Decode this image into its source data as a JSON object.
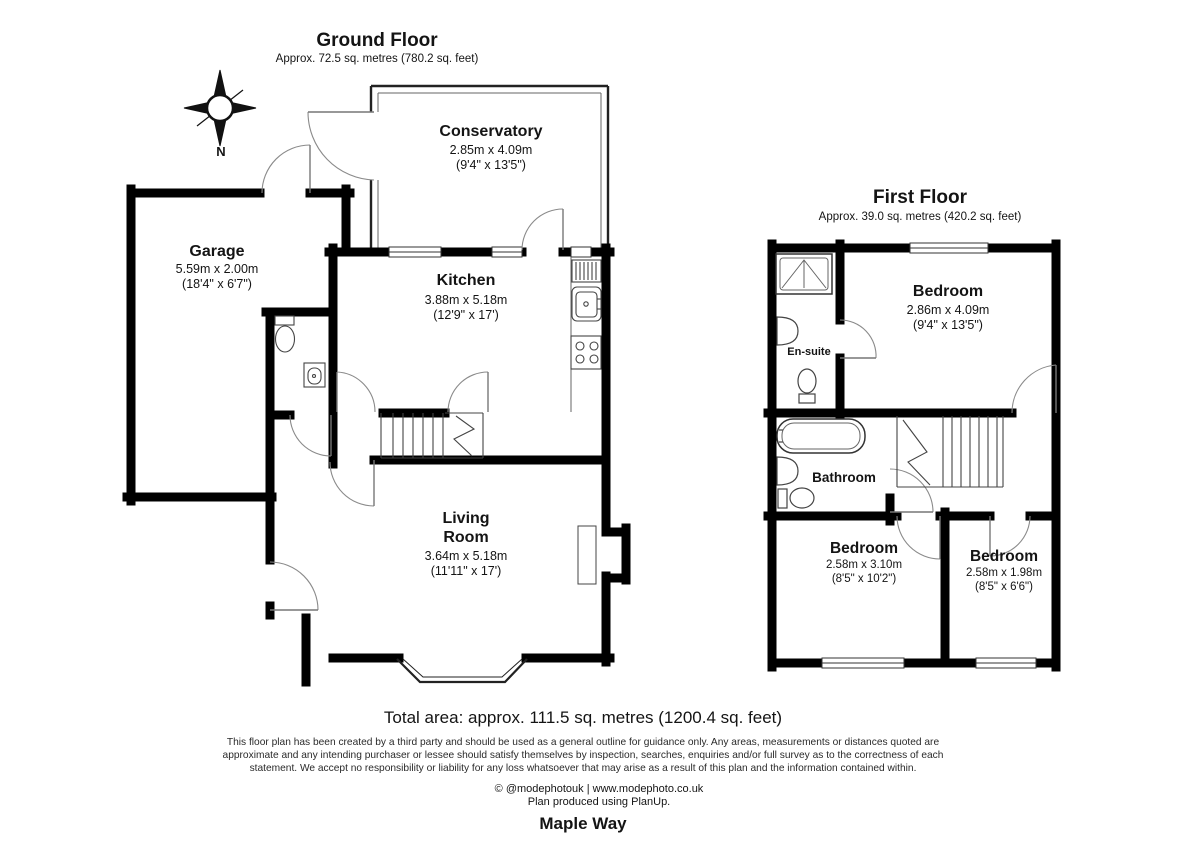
{
  "page": {
    "background": "#ffffff",
    "wall_color": "#000000"
  },
  "compass": {
    "label": "N"
  },
  "ground_floor": {
    "title": "Ground Floor",
    "area": "Approx. 72.5 sq. metres (780.2 sq. feet)",
    "rooms": {
      "conservatory": {
        "name": "Conservatory",
        "metric": "2.85m x 4.09m",
        "imperial": "(9'4\" x 13'5\")"
      },
      "garage": {
        "name": "Garage",
        "metric": "5.59m x 2.00m",
        "imperial": "(18'4\" x 6'7\")"
      },
      "kitchen": {
        "name": "Kitchen",
        "metric": "3.88m x 5.18m",
        "imperial": "(12'9\" x 17')"
      },
      "living_room": {
        "name_line1": "Living",
        "name_line2": "Room",
        "metric": "3.64m x 5.18m",
        "imperial": "(11'11\" x 17')"
      }
    }
  },
  "first_floor": {
    "title": "First Floor",
    "area": "Approx. 39.0 sq. metres (420.2 sq. feet)",
    "rooms": {
      "bedroom_main": {
        "name": "Bedroom",
        "metric": "2.86m x 4.09m",
        "imperial": "(9'4\" x 13'5\")"
      },
      "ensuite": {
        "name": "En-suite"
      },
      "bathroom": {
        "name": "Bathroom"
      },
      "bedroom_left": {
        "name": "Bedroom",
        "metric": "2.58m x 3.10m",
        "imperial": "(8'5\" x 10'2\")"
      },
      "bedroom_right": {
        "name": "Bedroom",
        "metric": "2.58m x 1.98m",
        "imperial": "(8'5\" x 6'6\")"
      }
    }
  },
  "footer": {
    "total_area": "Total area: approx. 111.5 sq. metres (1200.4 sq. feet)",
    "disclaimer": "This floor plan has been created by a third party and should be used as a general outline for guidance only. Any areas, measurements or distances quoted are approximate and any intending purchaser or lessee should satisfy themselves by inspection, searches, enquiries and/or full survey as to the correctness of each statement. We accept no responsibility or liability for any loss whatsoever that may arise as a result of this plan and the information contained within.",
    "credit": "© @modephotouk | www.modephoto.co.uk",
    "produced": "Plan produced using PlanUp.",
    "address": "Maple Way"
  }
}
